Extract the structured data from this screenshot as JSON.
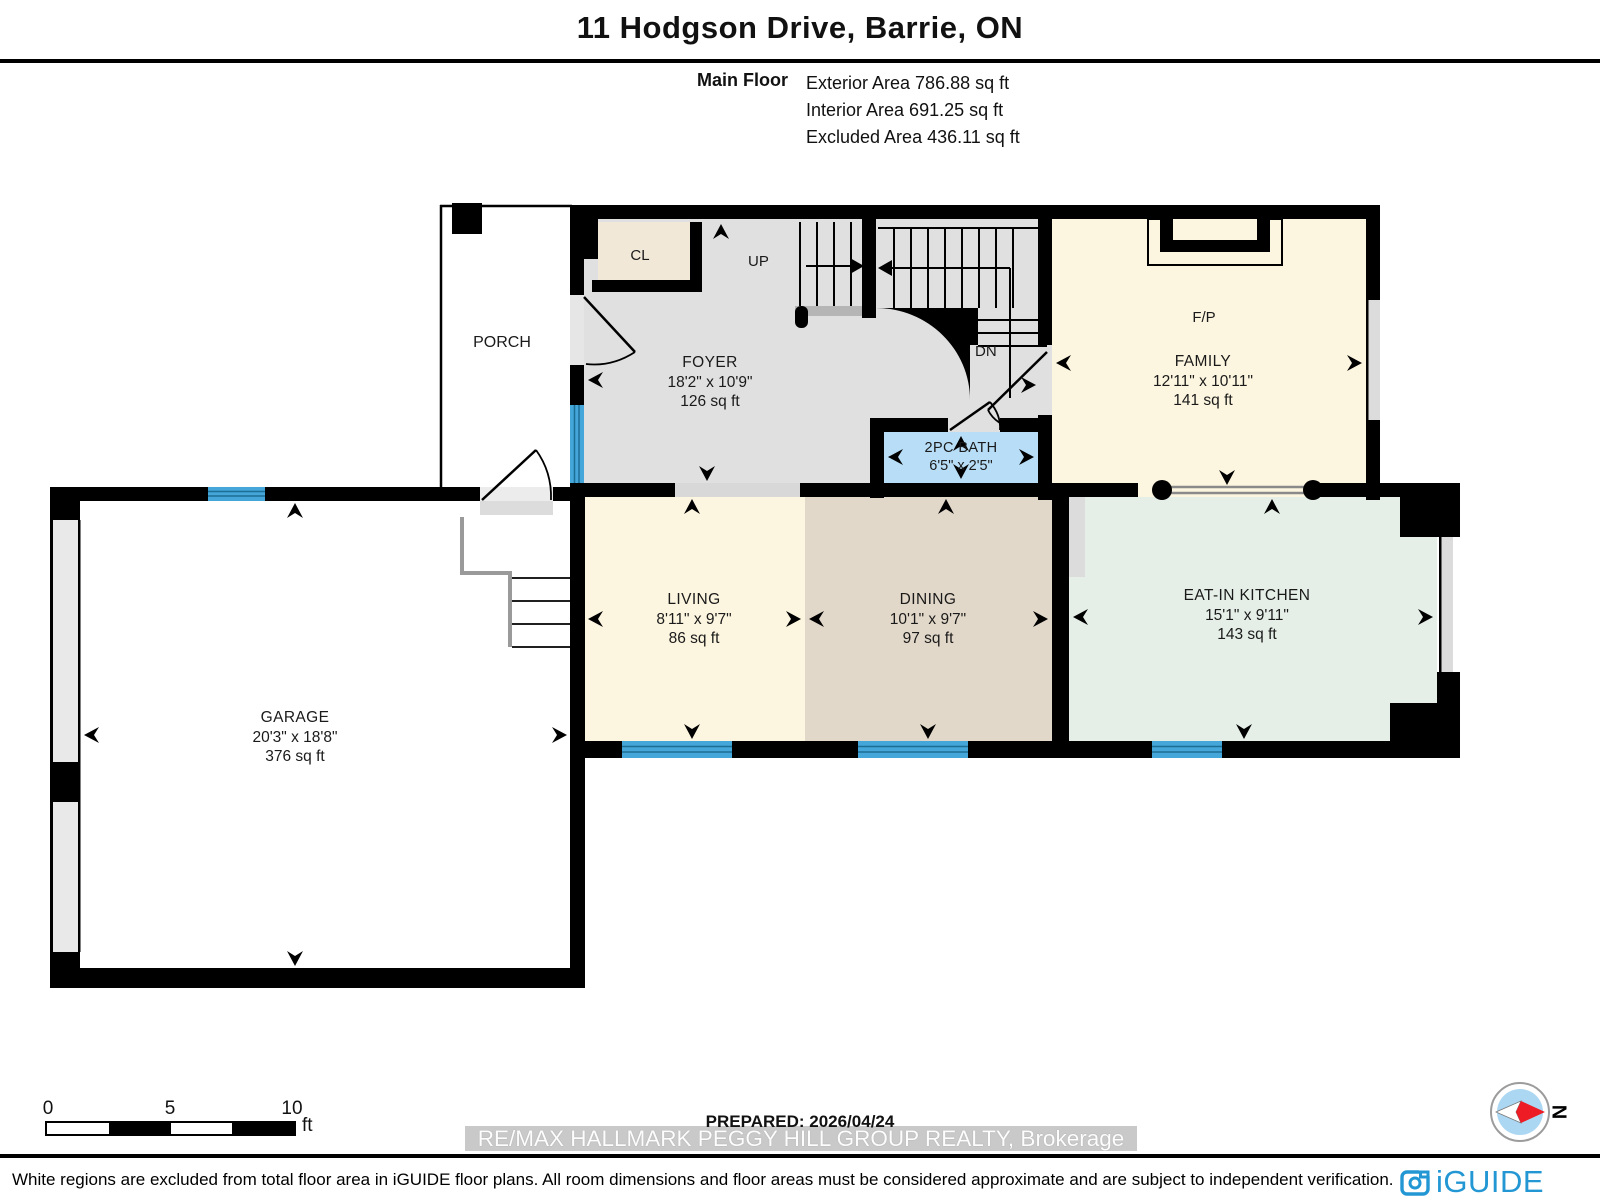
{
  "header": {
    "title": "11 Hodgson Drive, Barrie, ON",
    "floor_label": "Main Floor",
    "stats": [
      "Exterior Area 786.88 sq ft",
      "Interior Area 691.25 sq ft",
      "Excluded Area 436.11 sq ft"
    ]
  },
  "rooms": {
    "porch": {
      "name": "PORCH"
    },
    "closet": {
      "name": "CL"
    },
    "foyer": {
      "name": "FOYER",
      "dims": "18'2\" x 10'9\"",
      "area": "126 sq ft"
    },
    "stairs": {
      "up": "UP",
      "down": "DN"
    },
    "family": {
      "name": "FAMILY",
      "dims": "12'11\" x 10'11\"",
      "area": "141 sq ft",
      "fireplace": "F/P"
    },
    "bath": {
      "name": "2PC BATH",
      "dims": "6'5\" x 2'5\""
    },
    "living": {
      "name": "LIVING",
      "dims": "8'11\" x 9'7\"",
      "area": "86 sq ft"
    },
    "dining": {
      "name": "DINING",
      "dims": "10'1\" x 9'7\"",
      "area": "97 sq ft"
    },
    "kitchen": {
      "name": "EAT-IN KITCHEN",
      "dims": "15'1\" x 9'11\"",
      "area": "143 sq ft"
    },
    "garage": {
      "name": "GARAGE",
      "dims": "20'3\" x 18'8\"",
      "area": "376 sq ft"
    }
  },
  "scale_bar": {
    "ticks": [
      "0",
      "5",
      "10"
    ],
    "unit": "ft"
  },
  "prepared": {
    "label": "PREPARED: 2026/04/24"
  },
  "watermark": {
    "text": "RE/MAX HALLMARK PEGGY HILL GROUP REALTY, Brokerage"
  },
  "compass": {
    "north_label": "N"
  },
  "disclaimer": {
    "text": "White regions are excluded from total floor area in iGUIDE floor plans. All room dimensions and floor areas must be considered approximate and are subject to independent verification."
  },
  "brand": {
    "logo_text": "iGUIDE"
  },
  "colors": {
    "wall": "#000000",
    "foyer_floor": "#e0e0e0",
    "closet_floor": "#f2e8d8",
    "family_floor": "#fcf5df",
    "living_floor": "#fcf5df",
    "dining_floor": "#e2d8c9",
    "kitchen_floor": "#e5efe8",
    "bath_floor": "#b8def7",
    "window_blue": "#45a6d9",
    "watermark_band": "#c9c9c9",
    "iguide_blue": "#2397d3",
    "compass_red": "#ee1c24"
  }
}
